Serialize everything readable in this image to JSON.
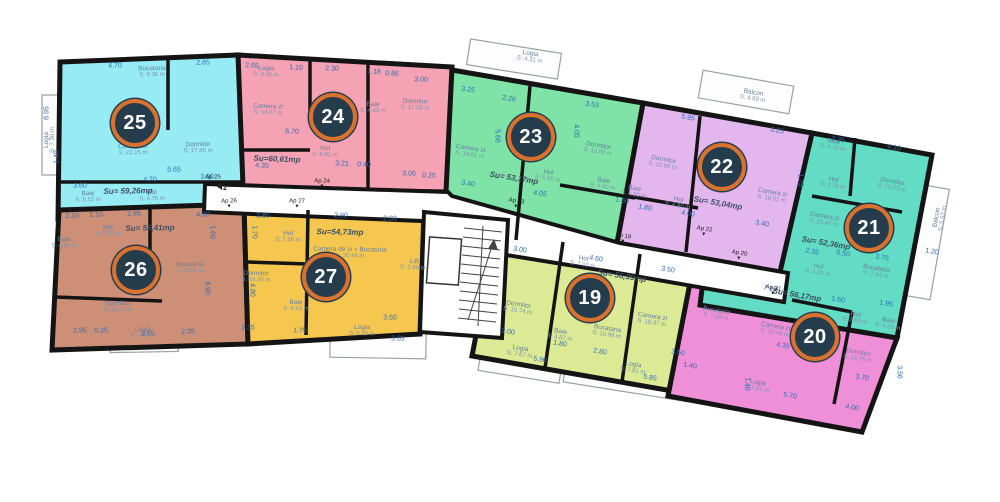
{
  "level_marker": "2",
  "core": {
    "lift_label": "Lift",
    "lift_area": "S: 2.89 m²"
  },
  "apartments": [
    {
      "id": "19",
      "number": "19",
      "su": "Su= 56,99mp",
      "entrance": "Ap 19",
      "color": "#dcea96",
      "rooms": [
        {
          "name": "Hol",
          "area": "S: 7.02 m"
        },
        {
          "name": "Dormitor",
          "area": "S: 15.74 m"
        },
        {
          "name": "Camera zi",
          "area": "S: 18.37 m"
        },
        {
          "name": "Bucataria",
          "area": "S: 10.99 m"
        },
        {
          "name": "Baie",
          "area": "S: 4.87 m"
        },
        {
          "name": "Logia",
          "area": "S: 7.67 m"
        },
        {
          "name": "Logia",
          "area": "S: 7.81 m"
        }
      ],
      "dims": [
        "3.00",
        "4.60",
        "3.50",
        "3.00",
        "1.80",
        "2.80",
        "5.90",
        "5.85",
        "3.50",
        "1.40"
      ]
    },
    {
      "id": "20",
      "number": "20",
      "su": "Su= 56,17mp",
      "entrance": "Ap 20",
      "color": "#ee8fd8",
      "rooms": [
        {
          "name": "Bucataria",
          "area": "S: 7.18 m"
        },
        {
          "name": "Camera zi",
          "area": "S: 20.46 m"
        },
        {
          "name": "Hol",
          "area": "S: 2.69 m"
        },
        {
          "name": "Baie",
          "area": "S: 4.28 m"
        },
        {
          "name": "Dormitor",
          "area": "S: 14.75 m"
        },
        {
          "name": "Logia",
          "area": "S: 7.61 m"
        }
      ],
      "dims": [
        "7.10",
        "1.60",
        "1.95",
        "4.35",
        "3.70",
        "4.00",
        "5.70",
        "3.56",
        "1.40"
      ]
    },
    {
      "id": "21",
      "number": "21",
      "su": "Su= 52,36mp",
      "entrance": "Ap 21",
      "color": "#62dcc4",
      "rooms": [
        {
          "name": "Baie",
          "area": "S: 4.70 m"
        },
        {
          "name": "Hol",
          "area": "S: 3.76 m"
        },
        {
          "name": "Dormitor",
          "area": "S: 13.23 m"
        },
        {
          "name": "Camera zi",
          "area": "S: 20.46 m"
        },
        {
          "name": "Hol",
          "area": "S: 4.33 m"
        },
        {
          "name": "Bucataria",
          "area": "S: 7.94 m"
        },
        {
          "name": "Balcon",
          "area": "S: 5.52 m"
        }
      ],
      "dims": [
        "2.35",
        "4.10",
        "2.35",
        "0.50",
        "3.75",
        "1.20",
        "1.75"
      ]
    },
    {
      "id": "22",
      "number": "22",
      "su": "Su= 53,04mp",
      "entrance": "Ap 22",
      "color": "#e3b6ee",
      "rooms": [
        {
          "name": "Dormitor",
          "area": "S: 12.86 m"
        },
        {
          "name": "Baie",
          "area": "S: 4.00 m"
        },
        {
          "name": "Hol",
          "area": "S: 6.80 m"
        },
        {
          "name": "Camera zi",
          "area": "S: 19.51 m"
        },
        {
          "name": "Balcon",
          "area": "S: 4.69 m"
        }
      ],
      "dims": [
        "5.95",
        "3.25",
        "1.80",
        "4.00",
        "3.40"
      ]
    },
    {
      "id": "23",
      "number": "23",
      "su": "Su= 53,17mp",
      "entrance": "Ap 23",
      "color": "#7fe3a8",
      "rooms": [
        {
          "name": "Camera zi",
          "area": "S: 19.61 m"
        },
        {
          "name": "Dormitor",
          "area": "S: 12.86 m"
        },
        {
          "name": "Hol",
          "area": "S: 5.55 m"
        },
        {
          "name": "Baie",
          "area": "S: 4.00 m"
        },
        {
          "name": "Logia",
          "area": "S: 4.31 m"
        }
      ],
      "dims": [
        "3.25",
        "2.26",
        "3.53",
        "4.05",
        "5.66",
        "3.40",
        "4.05",
        "1.60"
      ]
    },
    {
      "id": "24",
      "number": "24",
      "su": "Su=60,61mp",
      "entrance": "Ap 24",
      "color": "#f5a2b4",
      "rooms": [
        {
          "name": "Camera zi",
          "area": "S: 14.77 m"
        },
        {
          "name": "Baie",
          "area": "S: 4.43 m"
        },
        {
          "name": "Dormitor",
          "area": "S: 17.26 m"
        },
        {
          "name": "Hol",
          "area": "S: 6.92 m"
        },
        {
          "name": "Logia",
          "area": "S: 3.45 m"
        }
      ],
      "dims": [
        "2.65",
        "1.10",
        "2.30",
        "1.18",
        "0.86",
        "3.00",
        "6.70",
        "4.35",
        "3.21",
        "0.40",
        "3.05",
        "0.25"
      ]
    },
    {
      "id": "25",
      "number": "25",
      "su": "Su= 59,26mp",
      "entrance": "Ap 25",
      "color": "#97ebf3",
      "rooms": [
        {
          "name": "Bucataria",
          "area": "S: 9.36 m"
        },
        {
          "name": "Camera zi",
          "area": "S: 22.15 m"
        },
        {
          "name": "Dormitor",
          "area": "S: 17.45 m"
        },
        {
          "name": "Baie",
          "area": "S: 5.52 m"
        },
        {
          "name": "Hol",
          "area": "S: 4.75 m"
        },
        {
          "name": "Logia",
          "area": "S: 7.36 m"
        }
      ],
      "dims": [
        "4.70",
        "2.85",
        "4.70",
        "3.00",
        "3.60",
        "5.65",
        "6.95",
        "1.40"
      ]
    },
    {
      "id": "26",
      "number": "26",
      "su": "Su= 55,41mp",
      "entrance": "Ap 26",
      "color": "#ce8f77",
      "rooms": [
        {
          "name": "Hol",
          "area": "S: 3.85 m"
        },
        {
          "name": "Baie",
          "area": "S: 4.52 m"
        },
        {
          "name": "Dormitor",
          "area": "S: 12.53 m"
        },
        {
          "name": "Bucataria",
          "area": "S: 9.05 m"
        },
        {
          "name": "Logia",
          "area": "S: 3.45 m"
        }
      ],
      "dims": [
        "2.10",
        "1.10",
        "2.85",
        "4.30",
        "1.60",
        "4.90",
        "2.95",
        "0.35",
        "2.65",
        "2.35"
      ]
    },
    {
      "id": "27",
      "number": "27",
      "su": "Su=54,73mp",
      "entrance": "Ap 27",
      "color": "#f6c74f",
      "rooms": [
        {
          "name": "Hol",
          "area": "S: 7.56 m"
        },
        {
          "name": "Camera de zi + Bucataria",
          "area": "S: 20.44 m"
        },
        {
          "name": "Dormitor",
          "area": "S: 16.26 m"
        },
        {
          "name": "Baie",
          "area": "S: 4.63 m"
        },
        {
          "name": "Logia",
          "area": "S: 6.25 m"
        }
      ],
      "dims": [
        "2.85",
        "2.90",
        "2.03",
        "1.70",
        "4.80",
        "3.35",
        "1.75",
        "3.50",
        "3.63"
      ]
    }
  ]
}
